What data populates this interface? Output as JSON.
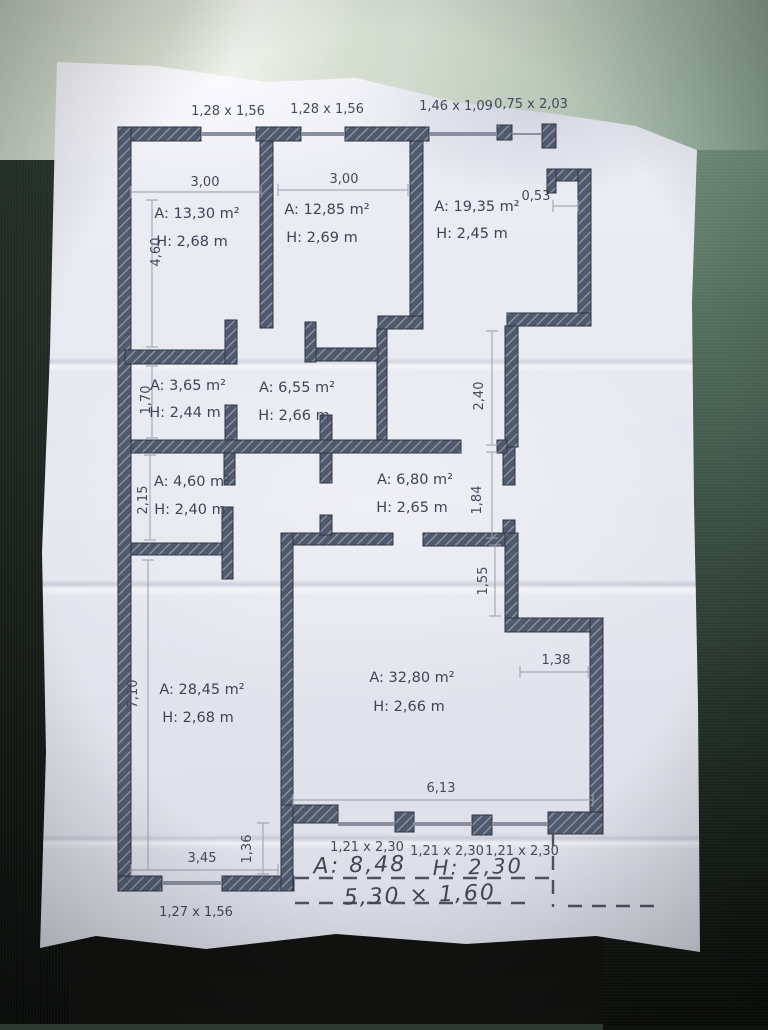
{
  "plan": {
    "top_openings": [
      {
        "label": "1,28 x 1,56"
      },
      {
        "label": "1,28 x 1,56"
      },
      {
        "label": "1,46 x 1,09"
      },
      {
        "label": "0,75 x 2,03"
      }
    ],
    "rooms": [
      {
        "area": "A: 13,30 m²",
        "ceiling": "H: 2,68 m"
      },
      {
        "area": "A: 12,85 m²",
        "ceiling": "H: 2,69 m"
      },
      {
        "area": "A: 19,35 m²",
        "ceiling": "H: 2,45 m"
      },
      {
        "area": "A: 3,65 m²",
        "ceiling": "H: 2,44 m"
      },
      {
        "area": "A: 6,55 m²",
        "ceiling": "H: 2,66 m"
      },
      {
        "area": "A: 4,60 m²",
        "ceiling": "H: 2,40 m"
      },
      {
        "area": "A: 6,80 m²",
        "ceiling": "H: 2,65 m"
      },
      {
        "area": "A: 28,45 m²",
        "ceiling": "H: 2,68 m"
      },
      {
        "area": "A: 32,80 m²",
        "ceiling": "H: 2,66 m"
      }
    ],
    "dims": {
      "room1_width": "3,00",
      "room2_width": "3,00",
      "niche_width": "0,53",
      "room1_depth": "4,60",
      "room4_depth": "1,70",
      "room6_depth": "2,15",
      "room8_depth": "7,10",
      "right_segment_upper": "2,40",
      "right_segment_middle": "1,84",
      "right_segment_lower": "1,55",
      "notch_width": "1,38",
      "room9_width": "6,13",
      "room8_width": "3,45",
      "recess_depth": "1,36"
    },
    "bottom_openings": [
      {
        "label": "1,21 x 2,30"
      },
      {
        "label": "1,21 x 2,30"
      },
      {
        "label": "1,21 x 2,30"
      },
      {
        "label": "1,27 x 1,56"
      }
    ],
    "handwritten": {
      "area": "A: 8,48",
      "ceiling": "H: 2,30",
      "size": "5,30 × 1,60"
    },
    "colors": {
      "wall_fill": "#515a6d",
      "wall_hatch": "#939bac",
      "paper": "#e8eaf2",
      "surface_green": "#55705f",
      "ink": "#3d4457"
    }
  }
}
